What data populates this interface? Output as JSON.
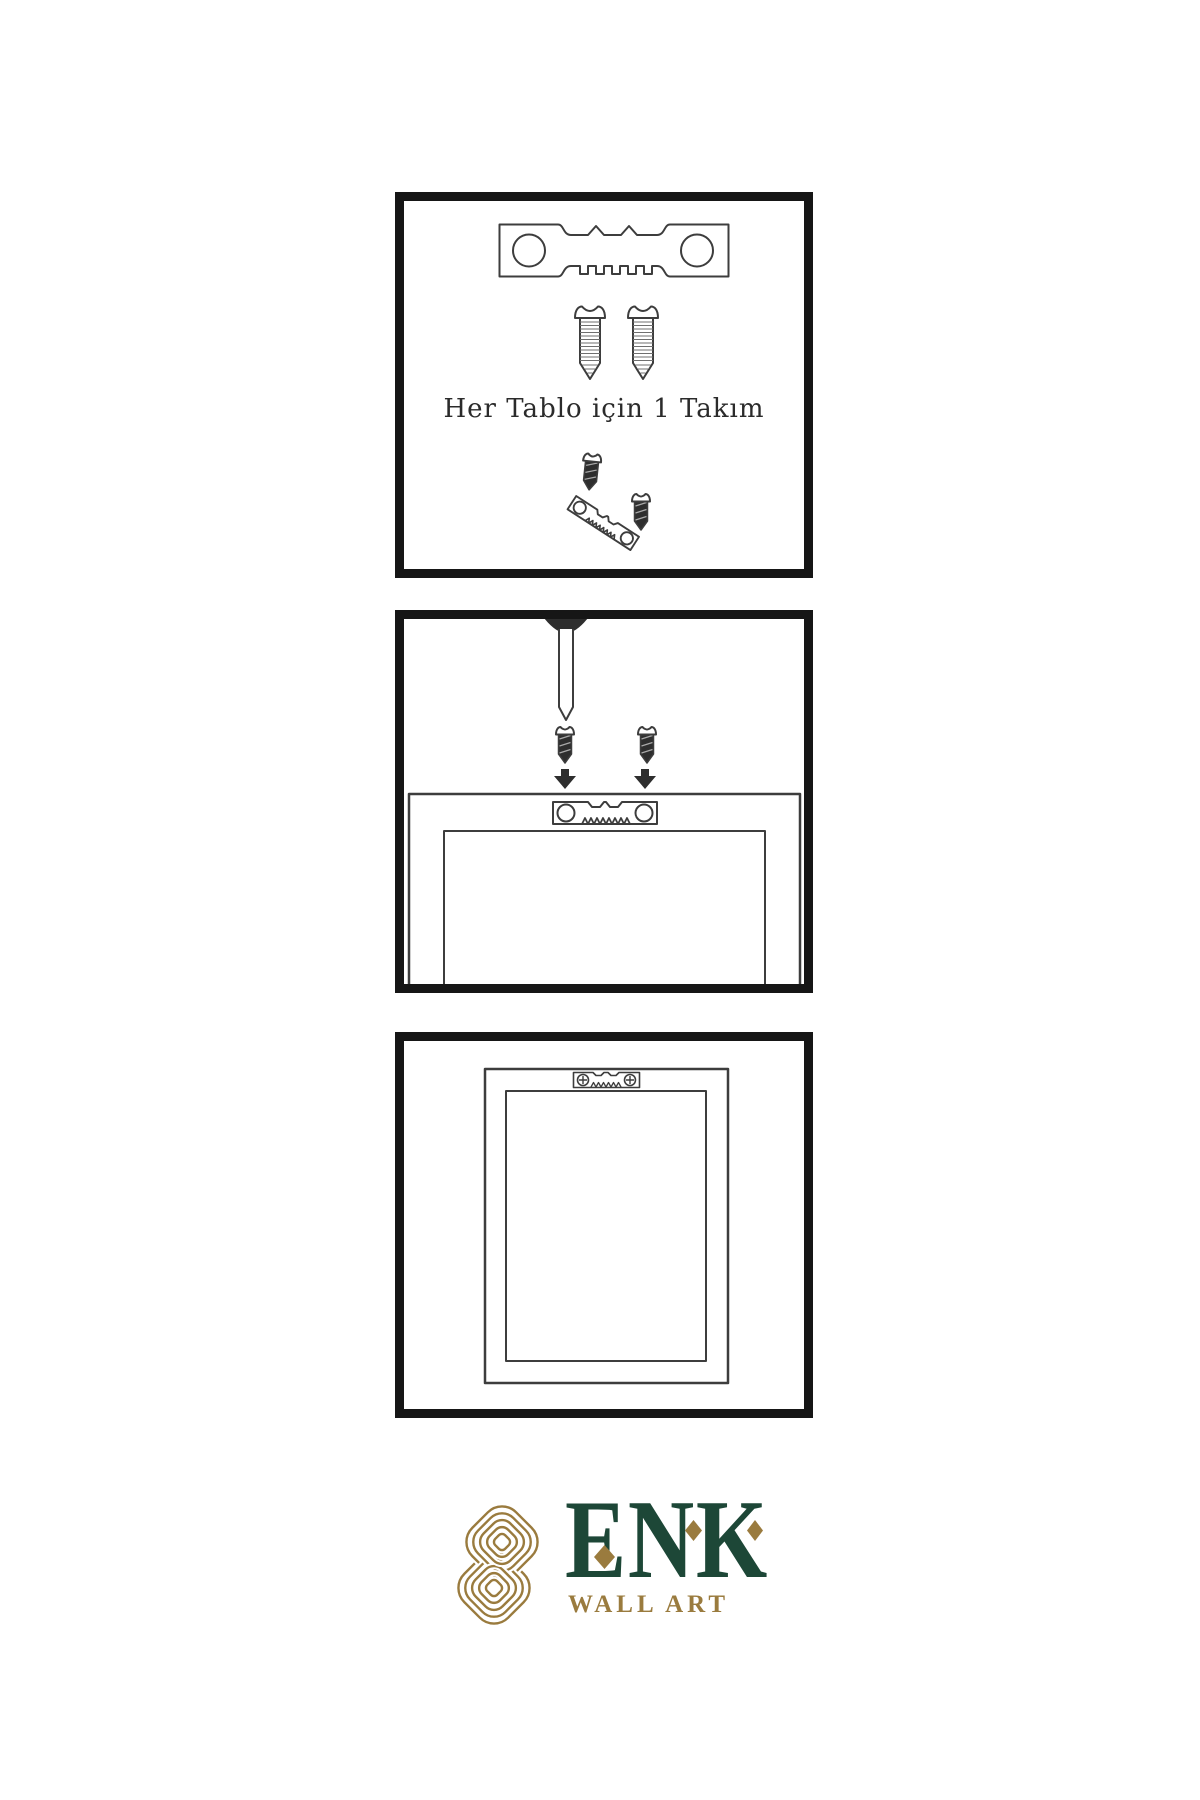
{
  "page": {
    "background": "#ffffff"
  },
  "colors": {
    "page_bg": "#ffffff",
    "panel_border": "#161616",
    "line": "#3d3d3d",
    "dark_fill": "#2e2e2e",
    "green": "#1d4737",
    "gold": "#9a7b3e"
  },
  "panel1": {
    "caption": "Her Tablo için 1 Takım"
  },
  "brand": {
    "name": "ENK",
    "tagline": "WALL ART"
  }
}
